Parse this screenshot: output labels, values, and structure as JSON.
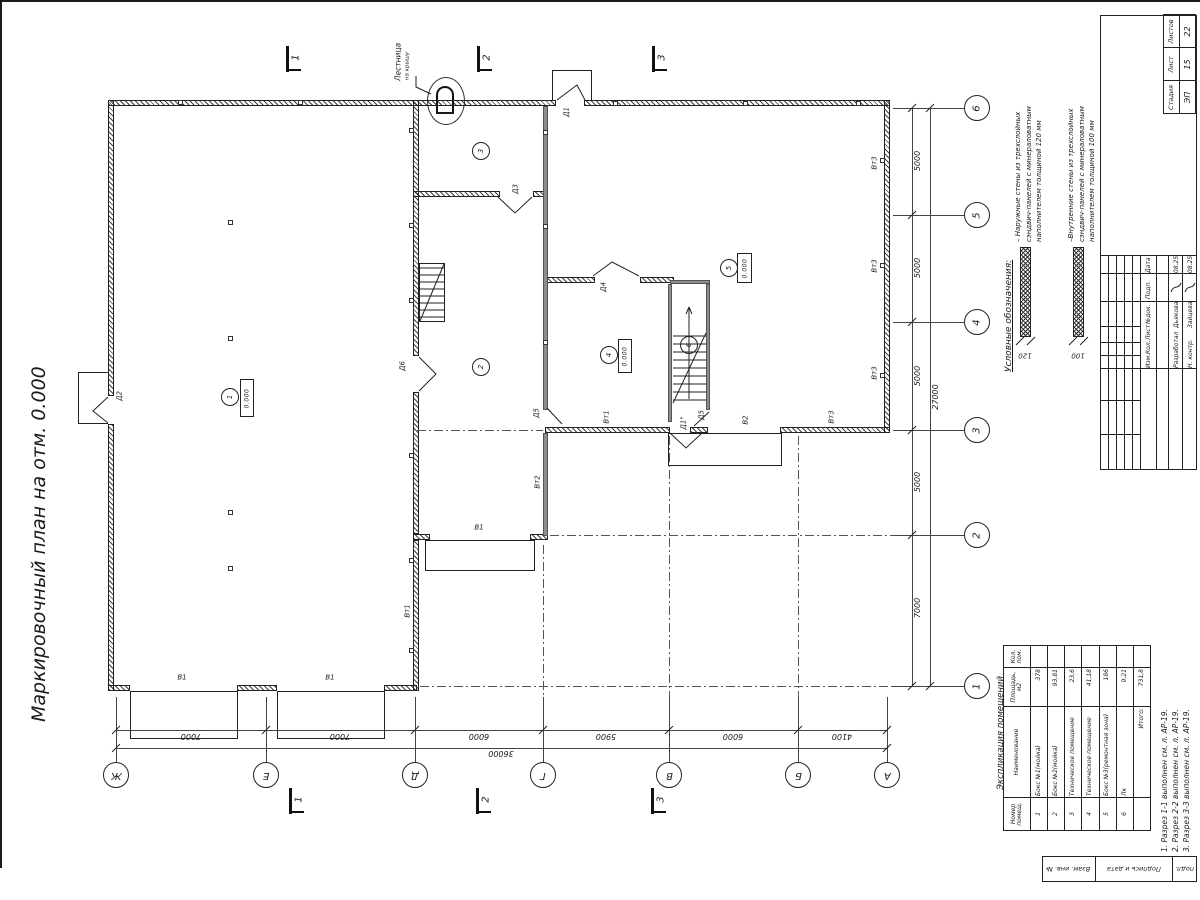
{
  "sheet_title": "Маркировочный план на отм. 0.000",
  "ladder": {
    "line1": "Лестница",
    "line2": "на крышу"
  },
  "legend": {
    "title": "Условные обозначения:",
    "items": [
      {
        "lines": [
          "– Наружные стены из трехслойных",
          "сэндвич-панелей с минераловатным",
          "наполнителем толщиной 120 мм"
        ],
        "thickness": "120"
      },
      {
        "lines": [
          "–Внутренние стены из трехслойных",
          "сэндвич-панелей с минераловатным",
          "наполнителем толщиной 100 мм"
        ],
        "thickness": "100"
      }
    ]
  },
  "grid": {
    "cols": [
      {
        "l": "Ж",
        "x": 116
      },
      {
        "l": "Е",
        "x": 266
      },
      {
        "l": "Д",
        "x": 415
      },
      {
        "l": "Г",
        "x": 543
      },
      {
        "l": "В",
        "x": 669
      },
      {
        "l": "Б",
        "x": 798
      },
      {
        "l": "А",
        "x": 887
      }
    ],
    "rows": [
      {
        "l": "6",
        "y": 108
      },
      {
        "l": "5",
        "y": 215
      },
      {
        "l": "4",
        "y": 322
      },
      {
        "l": "3",
        "y": 430
      },
      {
        "l": "2",
        "y": 535
      },
      {
        "l": "1",
        "y": 686
      }
    ]
  },
  "dims": {
    "bottom": [
      {
        "t": "7000",
        "x": 191
      },
      {
        "t": "7000",
        "x": 340
      },
      {
        "t": "6000",
        "x": 479
      },
      {
        "t": "5900",
        "x": 606
      },
      {
        "t": "6000",
        "x": 733
      },
      {
        "t": "4100",
        "x": 842
      }
    ],
    "bottom_total": {
      "t": "36000",
      "x": 501
    },
    "right": [
      {
        "t": "5000",
        "y": 161
      },
      {
        "t": "5000",
        "y": 268
      },
      {
        "t": "5000",
        "y": 376
      },
      {
        "t": "5000",
        "y": 482
      },
      {
        "t": "7000",
        "y": 608
      }
    ],
    "right_total": {
      "t": "27000",
      "y": 397
    }
  },
  "rooms": [
    {
      "n": "1",
      "cx": 230,
      "cy": 397,
      "box": [
        240,
        379,
        14,
        38
      ],
      "elev": "0.000"
    },
    {
      "n": "2",
      "cx": 481,
      "cy": 367
    },
    {
      "n": "3",
      "cx": 481,
      "cy": 151
    },
    {
      "n": "4",
      "cx": 609,
      "cy": 355,
      "box": [
        618,
        339,
        14,
        34
      ],
      "elev": "0.000"
    },
    {
      "n": "5",
      "cx": 729,
      "cy": 268,
      "box": [
        737,
        253,
        15,
        30
      ],
      "elev": "0.000"
    },
    {
      "n": "6",
      "cx": 689,
      "cy": 345
    }
  ],
  "plan_labels": [
    {
      "t": "Д1",
      "x": 567,
      "y": 112,
      "r": "v"
    },
    {
      "t": "Д2",
      "x": 120,
      "y": 396,
      "r": "v"
    },
    {
      "t": "Д3",
      "x": 516,
      "y": 189,
      "r": "v"
    },
    {
      "t": "Д4",
      "x": 604,
      "y": 287,
      "r": "v"
    },
    {
      "t": "Д5",
      "x": 537,
      "y": 413,
      "r": "v"
    },
    {
      "t": "Д5",
      "x": 702,
      "y": 415,
      "r": "v"
    },
    {
      "t": "Д1\"",
      "x": 684,
      "y": 423,
      "r": "v"
    },
    {
      "t": "Д6",
      "x": 403,
      "y": 366,
      "r": "v"
    },
    {
      "t": "В1",
      "x": 182,
      "y": 678,
      "r": "h"
    },
    {
      "t": "В1",
      "x": 330,
      "y": 678,
      "r": "h"
    },
    {
      "t": "В1",
      "x": 479,
      "y": 528,
      "r": "h"
    },
    {
      "t": "В2",
      "x": 746,
      "y": 420,
      "r": "v"
    },
    {
      "t": "Вт1",
      "x": 408,
      "y": 611,
      "r": "v"
    },
    {
      "t": "Вт1",
      "x": 607,
      "y": 417,
      "r": "v"
    },
    {
      "t": "Вт2",
      "x": 538,
      "y": 482,
      "r": "v"
    },
    {
      "t": "Вт3",
      "x": 875,
      "y": 163,
      "r": "v"
    },
    {
      "t": "Вт3",
      "x": 875,
      "y": 266,
      "r": "v"
    },
    {
      "t": "Вт3",
      "x": 875,
      "y": 373,
      "r": "v"
    },
    {
      "t": "Вт3",
      "x": 832,
      "y": 417,
      "r": "v"
    },
    {
      "t": "120",
      "x": 1025,
      "y": 355,
      "r": "f"
    },
    {
      "t": "100",
      "x": 1078,
      "y": 355,
      "r": "f"
    }
  ],
  "sections": {
    "top": [
      {
        "n": "1",
        "x": 287
      },
      {
        "n": "2",
        "x": 478
      },
      {
        "n": "3",
        "x": 653
      }
    ],
    "bottom": [
      {
        "n": "1",
        "x": 290
      },
      {
        "n": "2",
        "x": 477
      },
      {
        "n": "3",
        "x": 652
      }
    ]
  },
  "table": {
    "title": "Экспликация помещений",
    "headers": [
      "Номер помещ.",
      "Наименование",
      "Площадь, м2",
      "Кол. пом."
    ],
    "rows": [
      [
        "1",
        "Бокс №1(мойка)",
        "378",
        ""
      ],
      [
        "2",
        "Бокс №2(мойка)",
        "93,81",
        ""
      ],
      [
        "3",
        "Техническое помещение",
        "23,6",
        ""
      ],
      [
        "4",
        "Техническое помещение",
        "41,18",
        ""
      ],
      [
        "5",
        "Бокс №3(ремонтная зона)",
        "186",
        ""
      ],
      [
        "6",
        "Лк",
        "9,21",
        ""
      ]
    ],
    "total_label": "Итого:",
    "total_value": "731,8"
  },
  "notes": [
    "1. Разрез 1-1 выполнен см. л. АР-19.",
    "2. Разрез 2-2 выполнен см. л. АР-19.",
    "3. Разрез 3-3 выполнен см. л. АР-19."
  ],
  "stamp": {
    "stage_label": "Стадия",
    "sheet_label": "Лист",
    "sheets_label": "Листов",
    "stage": "ЭП",
    "sheet": "15",
    "sheets": "22",
    "rev_headers": [
      "Изм.",
      "Кол.",
      "Лист",
      "№док.",
      "Подп.",
      "Дата"
    ],
    "people": [
      {
        "role": "Разработал",
        "name": "Дьякова",
        "date": "08.25"
      },
      {
        "role": "Н. контр.",
        "name": "Зайцева",
        "date": "08.25"
      }
    ]
  },
  "side_stamp": [
    "Взам. инв. №",
    "Подпись и дата",
    "подл."
  ],
  "geometry": {
    "walls_ext": [
      [
        108,
        100,
        448,
        6
      ],
      [
        584,
        100,
        306,
        6
      ],
      [
        108,
        100,
        6,
        296
      ],
      [
        108,
        424,
        6,
        267
      ],
      [
        108,
        685,
        22,
        6
      ],
      [
        237,
        685,
        40,
        6
      ],
      [
        384,
        685,
        33,
        6
      ],
      [
        413,
        100,
        6,
        256
      ],
      [
        413,
        392,
        6,
        142
      ],
      [
        413,
        540,
        6,
        151
      ],
      [
        413,
        191,
        87,
        6
      ],
      [
        533,
        191,
        15,
        6
      ],
      [
        545,
        277,
        50,
        6
      ],
      [
        640,
        277,
        34,
        6
      ],
      [
        413,
        534,
        17,
        6
      ],
      [
        530,
        534,
        18,
        6
      ],
      [
        884,
        100,
        6,
        333
      ],
      [
        545,
        427,
        125,
        6
      ],
      [
        690,
        427,
        18,
        6
      ],
      [
        780,
        427,
        110,
        6
      ]
    ],
    "walls_int": [
      [
        543,
        106,
        5,
        304
      ],
      [
        543,
        433,
        5,
        103
      ],
      [
        670,
        280,
        40,
        4
      ],
      [
        668,
        284,
        4,
        138
      ],
      [
        706,
        284,
        4,
        126
      ]
    ],
    "aprons": [
      [
        130,
        691,
        108,
        48
      ],
      [
        277,
        691,
        108,
        48
      ],
      [
        425,
        540,
        110,
        31
      ],
      [
        668,
        433,
        114,
        33
      ]
    ],
    "vestibules": [
      [
        552,
        70,
        40,
        30
      ],
      [
        78,
        372,
        30,
        52
      ]
    ],
    "ladder_rect": [
      419,
      263,
      26,
      59
    ],
    "squares": [
      [
        411,
        130
      ],
      [
        411,
        225
      ],
      [
        411,
        300
      ],
      [
        411,
        455
      ],
      [
        411,
        560
      ],
      [
        411,
        650
      ],
      [
        545,
        132
      ],
      [
        545,
        226
      ],
      [
        545,
        342
      ],
      [
        180,
        102
      ],
      [
        300,
        102
      ],
      [
        615,
        103
      ],
      [
        745,
        103
      ],
      [
        858,
        103
      ],
      [
        882,
        160
      ],
      [
        882,
        265
      ],
      [
        882,
        375
      ],
      [
        230,
        222
      ],
      [
        230,
        338
      ],
      [
        230,
        512
      ],
      [
        230,
        568
      ]
    ],
    "dashdot_v": [
      [
        543,
        545,
        186
      ],
      [
        669,
        436,
        296
      ],
      [
        798,
        436,
        296
      ]
    ],
    "dashdot_h": [
      [
        420,
        686,
        492
      ],
      [
        550,
        535,
        362
      ],
      [
        417,
        430,
        126
      ]
    ],
    "stair1_steps": [
      673,
      706,
      336,
      400,
      8
    ],
    "ladder_rungs": [
      420,
      444,
      268,
      318,
      7
    ],
    "svg_paths": [
      "M557,100 L577,85 L585,100",
      "M108,397 L93,411 L108,423",
      "M498,197 L515,213 L532,197",
      "M593,276 L612,262 L639,276",
      "M419,357 L436,374 L419,391",
      "M547,408 L562,424",
      "M694,426 L709,412",
      "M670,433 L686,448 L702,433",
      "M673,403 L706,333",
      "M420,321 L444,264",
      "M416,76 L416,87 L431,94",
      "M689,399 L689,307 M689,307 L686,314 M689,307 L692,314",
      "M1016,345 L1024,337 M1027,345 L1035,337 M1069,345 L1077,337 M1080,345 L1088,337",
      "M1171,292 C1174,284 1178,290 1181,283",
      "M1185,292 C1188,284 1192,290 1195,283"
    ]
  }
}
